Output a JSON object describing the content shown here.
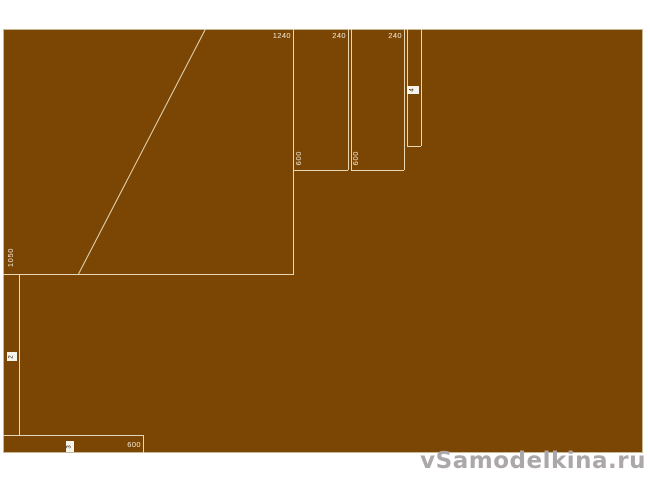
{
  "diagram": {
    "type": "panel-cutting-layout",
    "dimension_labels": {
      "big_width": "1240",
      "big_height": "1050",
      "strip1_width": "240",
      "strip1_height": "600",
      "strip2_width": "240",
      "strip2_height": "600",
      "bottom_strip_length": "600"
    },
    "piece_numbers": {
      "left_strip": "2",
      "bottom_strip": "3",
      "narrow_strip": "4"
    }
  },
  "watermark": {
    "text": "vSamodelkina.ru"
  },
  "colors": {
    "sheet": "#7b4503",
    "line": "#e6d8b4",
    "label": "#f5edda",
    "box_bg": "#f7f4ec",
    "box_text": "#33210a",
    "watermark": "#aca7a9",
    "border": "#c8b996",
    "page_bg": "#ffffff"
  }
}
